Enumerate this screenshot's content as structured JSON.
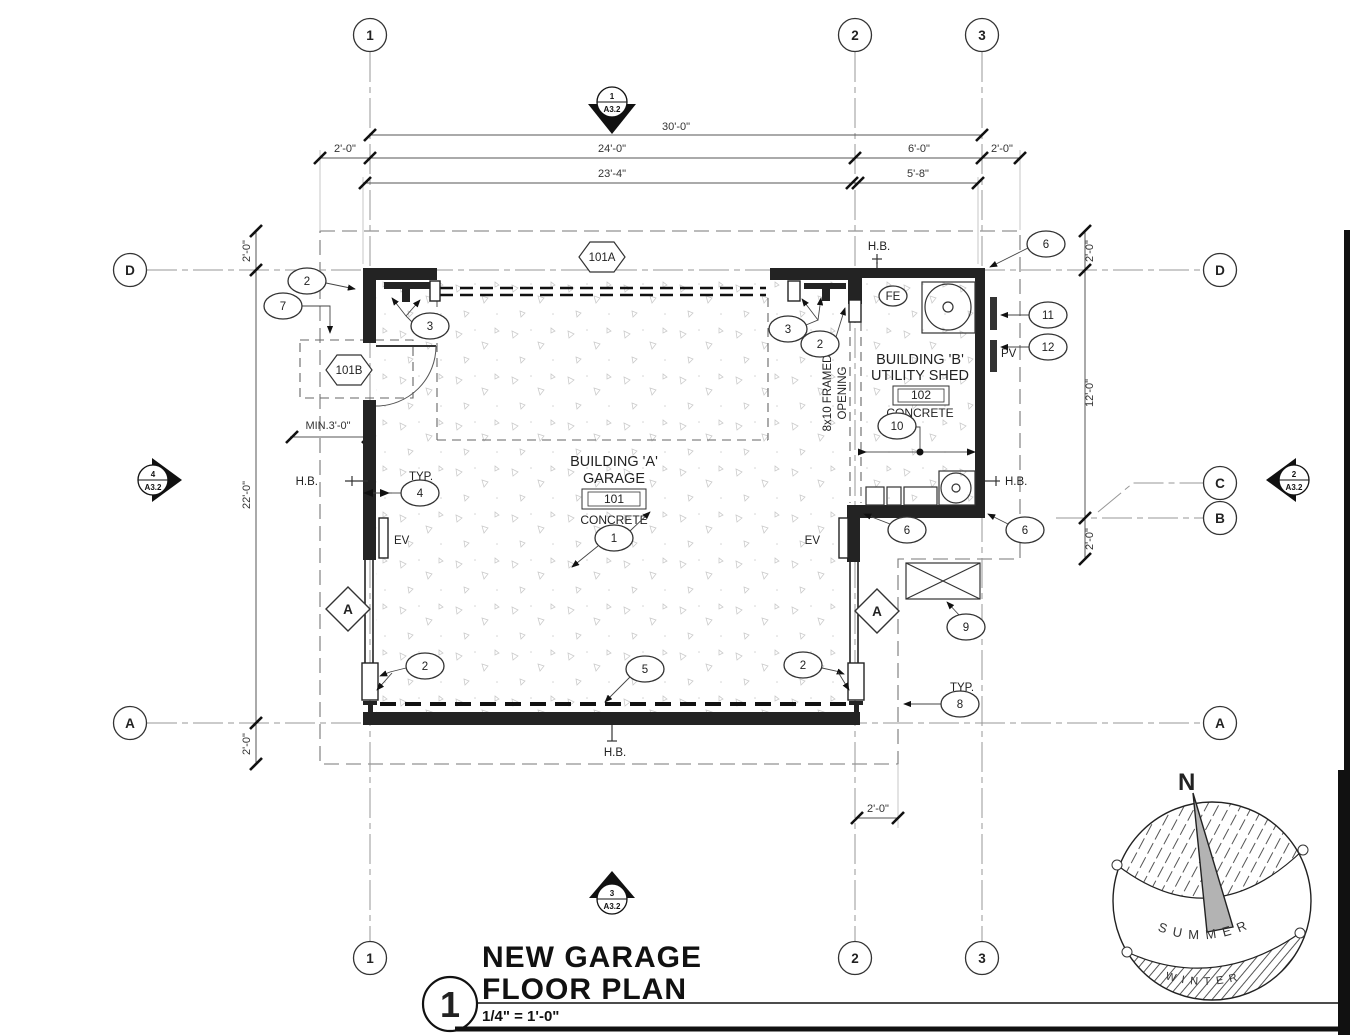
{
  "drawing": {
    "grid": {
      "c1": "1",
      "c2": "2",
      "c3": "3",
      "rD": "D",
      "rC": "C",
      "rB": "B",
      "rA": "A"
    },
    "sections": {
      "top": {
        "num": "1",
        "sheet": "A3.2"
      },
      "left": {
        "num": "4",
        "sheet": "A3.2"
      },
      "right": {
        "num": "2",
        "sheet": "A3.2"
      },
      "bottom": {
        "num": "3",
        "sheet": "A3.2"
      }
    },
    "dims": {
      "overall": "30'-0\"",
      "offL": "2'-0\"",
      "garageW": "24'-0\"",
      "shedW": "6'-0\"",
      "offR": "2'-0\"",
      "garageClr": "23'-4\"",
      "shedClr": "5'-8\"",
      "offTL": "2'-0\"",
      "heightL": "22'-0\"",
      "offBL": "2'-0\"",
      "offTR": "2'-0\"",
      "shedH": "12'-0\"",
      "offBR": "2'-0\"",
      "offB": "2'-0\"",
      "minClear": "MIN.3'-0\""
    },
    "labels": {
      "hb": "H.B.",
      "typ": "TYP.",
      "ev": "EV",
      "pv": "PV",
      "fe": "FE",
      "open1": "8x10 FRAMED",
      "open2": "OPENING",
      "wallTag": "A"
    },
    "rooms": {
      "a": {
        "l1": "BUILDING 'A'",
        "l2": "GARAGE",
        "num": "101",
        "fin": "CONCRETE",
        "door": "101A",
        "sideDoor": "101B"
      },
      "b": {
        "l1": "BUILDING 'B'",
        "l2": "UTILITY SHED",
        "num": "102",
        "fin": "CONCRETE"
      }
    },
    "callouts": {
      "k1": "1",
      "k2": "2",
      "k3": "3",
      "k4": "4",
      "k5": "5",
      "k6": "6",
      "k7": "7",
      "k8": "8",
      "k9": "9",
      "k10": "10",
      "k11": "11",
      "k12": "12"
    },
    "compass": {
      "n": "N",
      "summer": "SUMMER",
      "winter": "WINTER"
    },
    "titleblock": {
      "num": "1",
      "t1": "NEW GARAGE",
      "t2": "FLOOR PLAN",
      "scale": "1/4\" = 1'-0\""
    }
  }
}
